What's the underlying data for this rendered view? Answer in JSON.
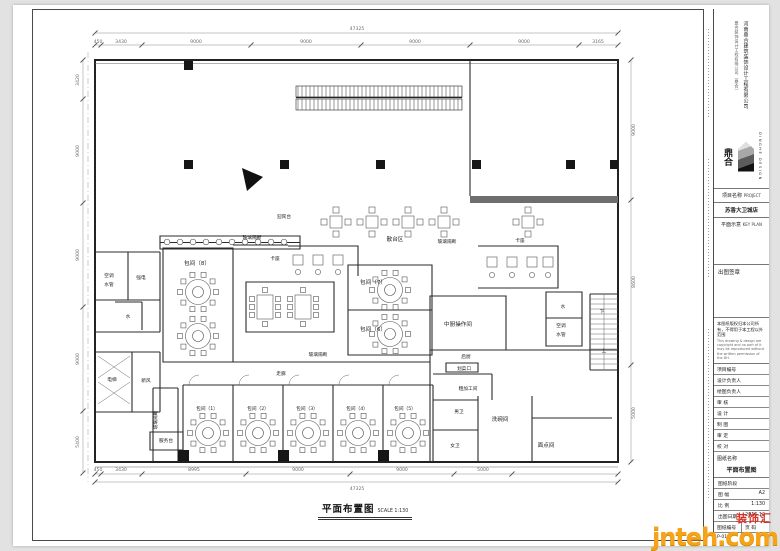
{
  "meta": {
    "colors": {
      "paper": "#ffffff",
      "line": "#2b2b2b",
      "dim": "#8a8a8a",
      "watermark_orange": "#f5a31a",
      "watermark_red": "#d93025"
    }
  },
  "title_block": {
    "company_vertical": "河南鼎合建筑装饰设计工程有限公司",
    "company_vertical2": "鼎合装饰设计工程有限公司（鼎合）",
    "logo_cn": "鼎合",
    "logo_text": "DINGHE DESIGN",
    "project_label": "项目名称",
    "project_label_en": "PROJECT",
    "project_name": "苏香大卫城店",
    "key_plan_label": "平面示意",
    "key_plan_en": "KEY PLAN",
    "stamp_label": "出图签章",
    "copyright_cn": "本图纸版权归本公司所有，不得用于本工程以外范围",
    "copyright_en": "This drawing & design are copyright and no part of it may be reproduced without the written permission of the DH.",
    "rows": [
      {
        "label": "项目编号"
      },
      {
        "label": "设计负责人"
      },
      {
        "label": "绘图负责人"
      },
      {
        "label": "审 核"
      },
      {
        "label": "设 计"
      },
      {
        "label": "制 图"
      },
      {
        "label": "审 定"
      },
      {
        "label": "校 对"
      }
    ],
    "drawing_name_label": "图纸名称",
    "drawing_name": "平面布置图",
    "stage_label": "图纸阶段",
    "size_label": "图 幅",
    "size_value": "A2",
    "scale_label": "比 例",
    "scale_value": "1:130",
    "date_label": "出图日期",
    "date_value": "2016.12",
    "no_label": "图纸编号",
    "page_label": "页 码",
    "no_value": "P-01"
  },
  "plan": {
    "title": "平面布置图",
    "title_scale": "SCALE 1:130",
    "labels": [
      {
        "t": "47325",
        "x": 357,
        "y": 30,
        "c": "dim"
      },
      {
        "t": "450",
        "x": 98,
        "y": 43,
        "c": "dim"
      },
      {
        "t": "3430",
        "x": 121,
        "y": 43,
        "c": "dim"
      },
      {
        "t": "9000",
        "x": 196,
        "y": 43,
        "c": "dim"
      },
      {
        "t": "9000",
        "x": 306,
        "y": 43,
        "c": "dim"
      },
      {
        "t": "9000",
        "x": 415,
        "y": 43,
        "c": "dim"
      },
      {
        "t": "9000",
        "x": 524,
        "y": 43,
        "c": "dim"
      },
      {
        "t": "3165",
        "x": 598,
        "y": 43,
        "c": "dim"
      },
      {
        "t": "450",
        "x": 98,
        "y": 471,
        "c": "dim"
      },
      {
        "t": "3430",
        "x": 121,
        "y": 471,
        "c": "dim"
      },
      {
        "t": "8995",
        "x": 194,
        "y": 471,
        "c": "dim"
      },
      {
        "t": "9000",
        "x": 298,
        "y": 471,
        "c": "dim"
      },
      {
        "t": "9000",
        "x": 402,
        "y": 471,
        "c": "dim"
      },
      {
        "t": "5000",
        "x": 483,
        "y": 471,
        "c": "dim"
      },
      {
        "t": "47325",
        "x": 357,
        "y": 490,
        "c": "dim"
      },
      {
        "t": "3420",
        "x": 79,
        "y": 80,
        "c": "dim",
        "r": -90
      },
      {
        "t": "9000",
        "x": 79,
        "y": 151,
        "c": "dim",
        "r": -90
      },
      {
        "t": "9000",
        "x": 79,
        "y": 255,
        "c": "dim",
        "r": -90
      },
      {
        "t": "9000",
        "x": 79,
        "y": 359,
        "c": "dim",
        "r": -90
      },
      {
        "t": "5400",
        "x": 79,
        "y": 442,
        "c": "dim",
        "r": -90
      },
      {
        "t": "9000",
        "x": 635,
        "y": 130,
        "c": "dim",
        "r": -90
      },
      {
        "t": "8600",
        "x": 635,
        "y": 282,
        "c": "dim",
        "r": -90
      },
      {
        "t": "5000",
        "x": 635,
        "y": 413,
        "c": "dim",
        "r": -90
      },
      {
        "t": "散台区",
        "x": 395,
        "y": 241,
        "c": "room"
      },
      {
        "t": "卡座",
        "x": 275,
        "y": 260,
        "c": "small"
      },
      {
        "t": "卡座",
        "x": 520,
        "y": 242,
        "c": "small"
      },
      {
        "t": "迎宾台",
        "x": 284,
        "y": 218,
        "c": "small"
      },
      {
        "t": "玻璃隔断",
        "x": 252,
        "y": 239,
        "c": "small"
      },
      {
        "t": "玻璃隔断",
        "x": 447,
        "y": 243,
        "c": "small"
      },
      {
        "t": "玻璃隔断",
        "x": 318,
        "y": 356,
        "c": "small"
      },
      {
        "t": "玻璃隔断",
        "x": 157,
        "y": 420,
        "c": "small",
        "r": -90
      },
      {
        "t": "包间（8）",
        "x": 197,
        "y": 265,
        "c": "room"
      },
      {
        "t": "包间（7）",
        "x": 373,
        "y": 284,
        "c": "room"
      },
      {
        "t": "包间（6）",
        "x": 373,
        "y": 331,
        "c": "room"
      },
      {
        "t": "中厨操作间",
        "x": 458,
        "y": 326,
        "c": "room"
      },
      {
        "t": "后厨",
        "x": 466,
        "y": 358,
        "c": "small"
      },
      {
        "t": "划菜口",
        "x": 464,
        "y": 370,
        "c": "small"
      },
      {
        "t": "粗加工间",
        "x": 468,
        "y": 390,
        "c": "small"
      },
      {
        "t": "男卫",
        "x": 459,
        "y": 413,
        "c": "small"
      },
      {
        "t": "女卫",
        "x": 455,
        "y": 447,
        "c": "small"
      },
      {
        "t": "洗碗间",
        "x": 500,
        "y": 421,
        "c": "room"
      },
      {
        "t": "面点间",
        "x": 546,
        "y": 447,
        "c": "room"
      },
      {
        "t": "走廊",
        "x": 281,
        "y": 375,
        "c": "small"
      },
      {
        "t": "包间（1）",
        "x": 207,
        "y": 410,
        "c": "small"
      },
      {
        "t": "包间（2）",
        "x": 258,
        "y": 410,
        "c": "small"
      },
      {
        "t": "包间（3）",
        "x": 307,
        "y": 410,
        "c": "small"
      },
      {
        "t": "包间（4）",
        "x": 357,
        "y": 410,
        "c": "small"
      },
      {
        "t": "包间（5）",
        "x": 405,
        "y": 410,
        "c": "small"
      },
      {
        "t": "服务台",
        "x": 166,
        "y": 442,
        "c": "small"
      },
      {
        "t": "空调",
        "x": 109,
        "y": 277,
        "c": "small"
      },
      {
        "t": "水管",
        "x": 109,
        "y": 286,
        "c": "small"
      },
      {
        "t": "强电",
        "x": 141,
        "y": 279,
        "c": "small"
      },
      {
        "t": "水",
        "x": 128,
        "y": 318,
        "c": "small"
      },
      {
        "t": "电梯",
        "x": 112,
        "y": 381,
        "c": "small"
      },
      {
        "t": "新风",
        "x": 146,
        "y": 382,
        "c": "small"
      },
      {
        "t": "水",
        "x": 563,
        "y": 308,
        "c": "small"
      },
      {
        "t": "空调",
        "x": 561,
        "y": 327,
        "c": "small"
      },
      {
        "t": "水管",
        "x": 561,
        "y": 336,
        "c": "small"
      },
      {
        "t": "下",
        "x": 602,
        "y": 313,
        "c": "small"
      },
      {
        "t": "上",
        "x": 604,
        "y": 352,
        "c": "small"
      }
    ],
    "furniture": {
      "round_tables": [
        [
          198,
          292
        ],
        [
          198,
          336
        ],
        [
          390,
          290
        ],
        [
          390,
          334
        ],
        [
          208,
          433
        ],
        [
          258,
          433
        ],
        [
          308,
          433
        ],
        [
          358,
          433
        ],
        [
          408,
          433
        ]
      ],
      "sq_tables": [
        [
          336,
          222
        ],
        [
          372,
          222
        ],
        [
          408,
          222
        ],
        [
          444,
          222
        ],
        [
          528,
          222
        ]
      ],
      "rect_tables": [
        [
          265,
          307
        ],
        [
          303,
          307
        ]
      ],
      "booth_tables": [
        [
          298,
          260
        ],
        [
          318,
          260
        ],
        [
          338,
          260
        ],
        [
          492,
          262
        ],
        [
          512,
          262
        ],
        [
          532,
          262
        ],
        [
          548,
          262
        ]
      ],
      "stools": [
        [
          298,
          272
        ],
        [
          318,
          272
        ],
        [
          338,
          272
        ],
        [
          492,
          275
        ],
        [
          512,
          275
        ],
        [
          532,
          275
        ],
        [
          548,
          275
        ]
      ],
      "counter_seats": [
        [
          167,
          242
        ],
        [
          180,
          242
        ],
        [
          193,
          242
        ],
        [
          206,
          242
        ],
        [
          219,
          242
        ],
        [
          232,
          242
        ],
        [
          245,
          242
        ],
        [
          258,
          242
        ],
        [
          271,
          242
        ],
        [
          284,
          242
        ]
      ]
    },
    "dim_ticks": {
      "top": [
        95,
        101,
        142,
        251,
        361,
        470,
        579,
        618
      ],
      "bottom": [
        95,
        101,
        142,
        246,
        350,
        454,
        512,
        618
      ],
      "left": [
        60,
        99,
        203,
        307,
        411,
        473
      ],
      "right": [
        60,
        200,
        365,
        462
      ]
    }
  },
  "watermark": {
    "site": "jnteh.com",
    "badge": "装饰汇"
  }
}
